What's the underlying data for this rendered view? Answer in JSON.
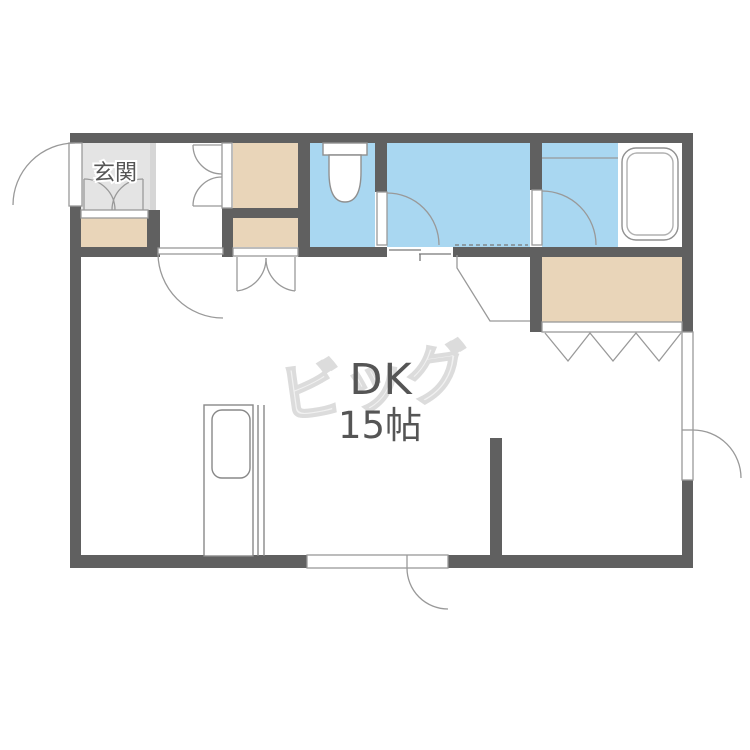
{
  "page": {
    "title": "Apartment floor plan 1R/DK"
  },
  "labels": {
    "genkan": "玄関",
    "dk": "DK",
    "dk_size": "15帖",
    "watermark": "ビッグ"
  },
  "colors": {
    "wall": "#606060",
    "water_blue": "#a9d7f1",
    "storage_beige": "#e9d5b9",
    "genkan_gray": "#e4e4e4",
    "genkan_edge_gray": "#d6d6d6",
    "fixture_line": "#909090",
    "thin_line": "#999999",
    "label_text": "#555555",
    "watermark_gray": "#e0e0e0"
  },
  "rooms": [
    {
      "name": "genkan",
      "label": "玄関",
      "fill": "genkan_gray"
    },
    {
      "name": "hall",
      "label": "",
      "fill": "white"
    },
    {
      "name": "shoe-cabinet",
      "label": "",
      "fill": "storage_beige",
      "door": "double-hinged"
    },
    {
      "name": "closet-upper",
      "label": "",
      "fill": "storage_beige",
      "door": "double-hinged"
    },
    {
      "name": "closet-lower",
      "label": "",
      "fill": "storage_beige",
      "door": "double-hinged"
    },
    {
      "name": "toilet",
      "label": "",
      "fill": "water_blue",
      "fixture": "toilet",
      "door": "hinged"
    },
    {
      "name": "washroom",
      "label": "",
      "fill": "water_blue",
      "door": "sliding"
    },
    {
      "name": "bathroom",
      "label": "",
      "fill": "water_blue",
      "fixture": "bathtub",
      "door": "hinged"
    },
    {
      "name": "storage-right",
      "label": "",
      "fill": "storage_beige",
      "door": "bifold"
    },
    {
      "name": "dining-kitchen",
      "label": "DK 15帖",
      "fill": "white",
      "fixture": "kitchen-sink"
    }
  ],
  "doors": [
    {
      "name": "entrance-door",
      "type": "hinged",
      "swing": "outward-left"
    },
    {
      "name": "hall-dk-door",
      "type": "hinged",
      "swing": "into-dk"
    },
    {
      "name": "toilet-door",
      "type": "hinged",
      "swing": "into-washroom"
    },
    {
      "name": "washroom-sliding-door",
      "type": "sliding"
    },
    {
      "name": "bath-door",
      "type": "hinged",
      "swing": "into-bathroom"
    },
    {
      "name": "storage-right-door",
      "type": "bifold"
    },
    {
      "name": "balcony-door-right",
      "type": "hinged",
      "swing": "outward-right"
    },
    {
      "name": "balcony-door-bottom",
      "type": "hinged",
      "swing": "outward-bottom"
    }
  ]
}
